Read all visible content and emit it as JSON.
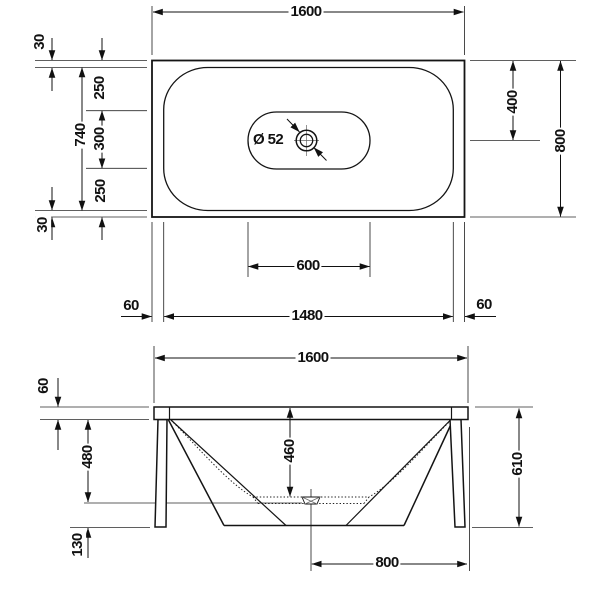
{
  "colors": {
    "background": "#ffffff",
    "line": "#141414"
  },
  "plan_view": {
    "overall_width": "1600",
    "rim_offset_top": "30",
    "inner_width": "740",
    "segment_top": "250",
    "segment_middle": "300",
    "segment_bottom": "250",
    "rim_offset_bottom": "30",
    "drain_offset_from_top": "400",
    "overall_depth": "800",
    "drain_diameter": "Ø 52",
    "flat_bottom_width": "600",
    "rim_edge_left": "60",
    "inner_length": "1480",
    "rim_edge_right": "60"
  },
  "front_view": {
    "overall_width": "1600",
    "rim_height": "60",
    "rim_to_bottom_depth": "480",
    "base_clearance": "130",
    "interior_depth": "460",
    "overall_height": "610",
    "center_to_edge": "800"
  }
}
